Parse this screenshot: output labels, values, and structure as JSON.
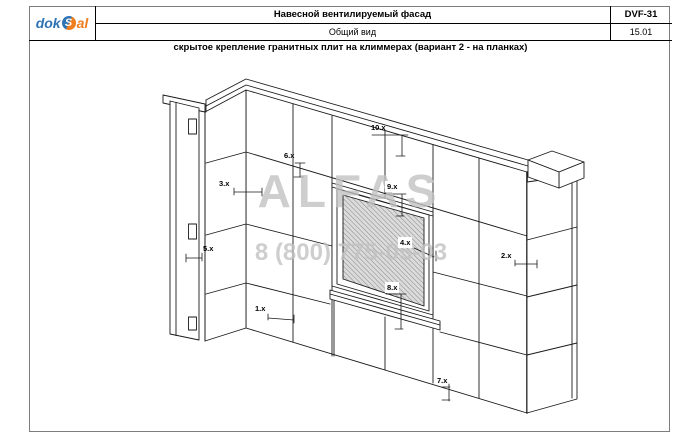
{
  "titleblock": {
    "logo": {
      "dok": "dok",
      "s": "S",
      "al": "al"
    },
    "project_title": "Навесной вентилируемый фасад",
    "doc_code": "DVF-31",
    "view_name": "Общий вид",
    "sheet_no": "15.01",
    "drawing_title": "скрытое крепление гранитных плит на климмерах (вариант 2 - на планках)"
  },
  "drawing": {
    "description": "axonometric view of ventilated facade wall corner with granite cladding tiles, parapet coping, left pilaster with clamps and hatched window opening",
    "callouts": [
      {
        "label": "10.x"
      },
      {
        "label": "6.x"
      },
      {
        "label": "3.x"
      },
      {
        "label": "9.x"
      },
      {
        "label": "5.x"
      },
      {
        "label": "4.x"
      },
      {
        "label": "8.x"
      },
      {
        "label": "1.x"
      },
      {
        "label": "2.x"
      },
      {
        "label": "7.x"
      }
    ]
  },
  "watermark": {
    "name": "ALFAS",
    "phone": "8 (800) 775-05-03"
  },
  "colors": {
    "logo_blue": "#2e74b5",
    "logo_orange": "#ee7e1e",
    "watermark_gray": "#c2c2c2",
    "line_black": "#1a1a1a"
  }
}
